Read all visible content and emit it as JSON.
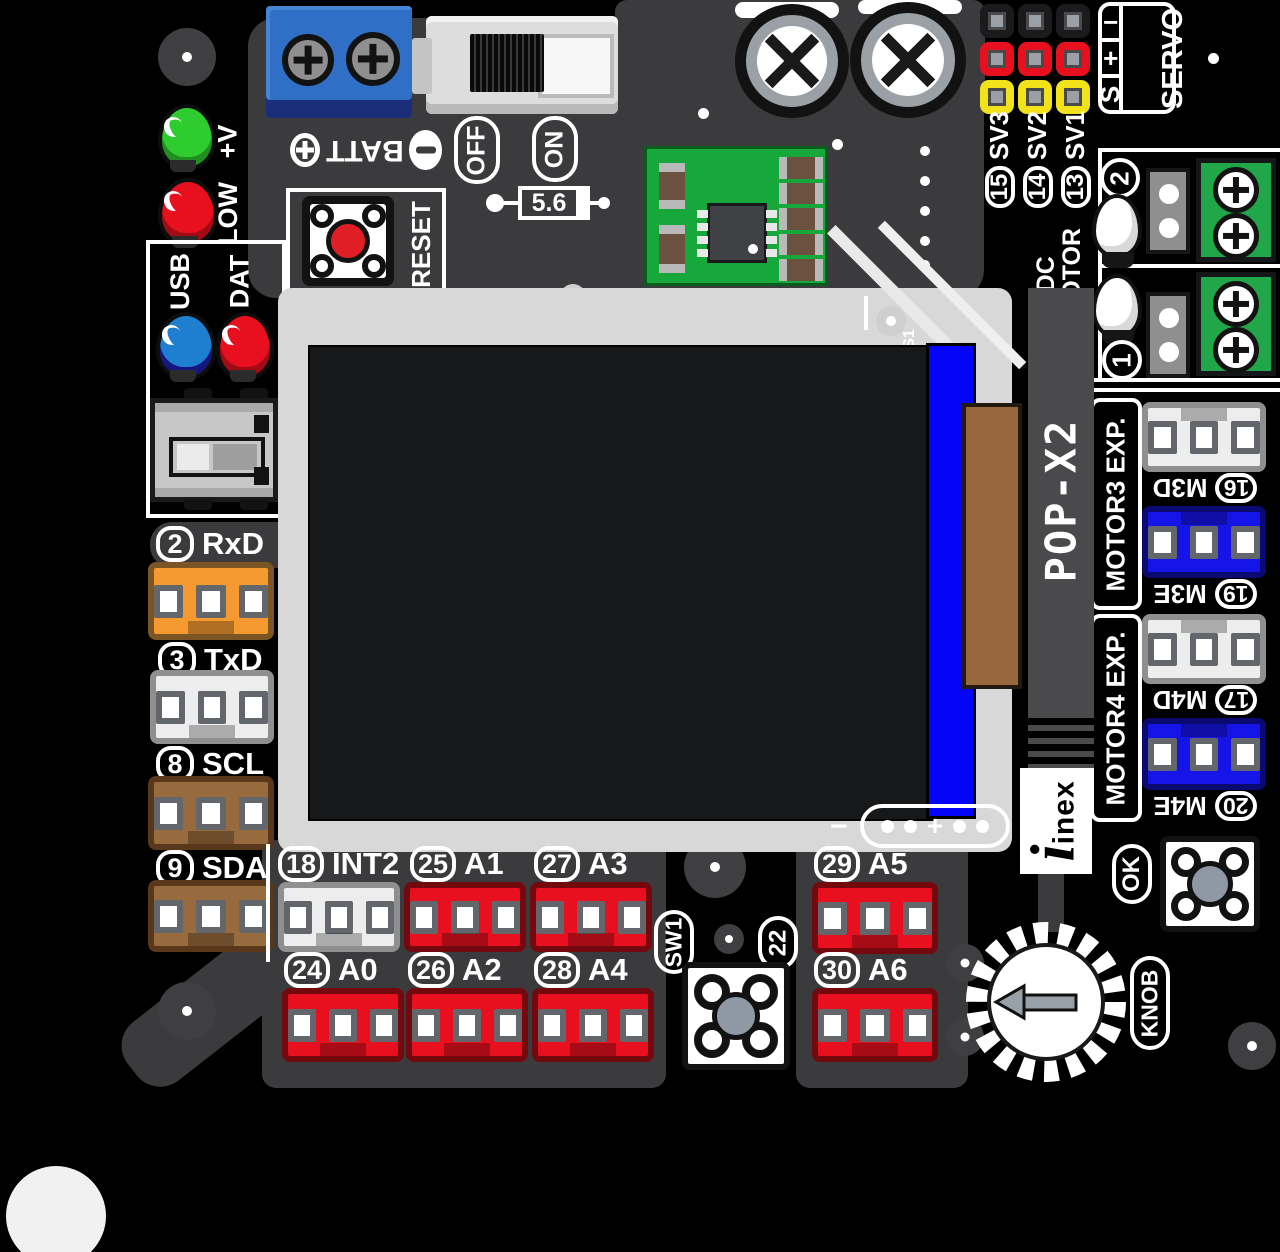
{
  "board": {
    "model": "POP-X2",
    "brand": "inex",
    "screen_marking": "S1"
  },
  "power": {
    "battery_label": "BATT",
    "battery_plus": "+",
    "battery_minus": "−",
    "switch_off": "OFF",
    "switch_on": "ON",
    "zener_value": "5.6",
    "reset_label": "RESET"
  },
  "status_leds": [
    {
      "label": "+V",
      "color": "#2ECC2E"
    },
    {
      "label": "LOW",
      "color": "#E8101F"
    },
    {
      "label": "USB",
      "color": "#1E7FD0"
    },
    {
      "label": "DAT",
      "color": "#E8101F"
    }
  ],
  "servo": {
    "title": "SERVO",
    "pin_rows": [
      {
        "label": "−",
        "color": "#1B1B1D"
      },
      {
        "label": "+",
        "color": "#E8101F"
      },
      {
        "label": "S",
        "color": "#F2E21A"
      }
    ],
    "channels": [
      {
        "num": "15",
        "name": "SV3"
      },
      {
        "num": "14",
        "name": "SV2"
      },
      {
        "num": "13",
        "name": "SV1"
      }
    ]
  },
  "dc_motor": {
    "line1": "DC",
    "line2": "MOTOR",
    "outputs": [
      {
        "num": "2"
      },
      {
        "num": "1"
      }
    ]
  },
  "motor_exp": [
    {
      "title": "MOTOR3 EXP.",
      "ports": [
        {
          "num": "16",
          "name": "M3D",
          "connector_color": "#EDEDED"
        },
        {
          "num": "19",
          "name": "M3E",
          "connector_color": "#1515E8"
        }
      ]
    },
    {
      "title": "MOTOR4 EXP.",
      "ports": [
        {
          "num": "17",
          "name": "M4D",
          "connector_color": "#EDEDED"
        },
        {
          "num": "20",
          "name": "M4E",
          "connector_color": "#1515E8"
        }
      ]
    }
  ],
  "left_headers": [
    {
      "num": "2",
      "name": "RxD",
      "connector_color": "#F49A30"
    },
    {
      "num": "3",
      "name": "TxD",
      "connector_color": "#EDEDED"
    },
    {
      "num": "8",
      "name": "SCL",
      "connector_color": "#976B3D"
    },
    {
      "num": "9",
      "name": "SDA",
      "connector_color": "#976B3D"
    }
  ],
  "bottom_headers": {
    "row1": [
      {
        "num": "18",
        "name": "INT2",
        "connector_color": "#EDEDED"
      },
      {
        "num": "25",
        "name": "A1",
        "connector_color": "#E8101F"
      },
      {
        "num": "27",
        "name": "A3",
        "connector_color": "#E8101F"
      },
      {
        "num": "29",
        "name": "A5",
        "connector_color": "#E8101F"
      }
    ],
    "row2": [
      {
        "num": "24",
        "name": "A0",
        "connector_color": "#E8101F"
      },
      {
        "num": "26",
        "name": "A2",
        "connector_color": "#E8101F"
      },
      {
        "num": "28",
        "name": "A4",
        "connector_color": "#E8101F"
      },
      {
        "num": "30",
        "name": "A6",
        "connector_color": "#E8101F"
      }
    ]
  },
  "buttons": {
    "sw1_label": "SW1",
    "sw1_pin": "22",
    "ok_label": "OK",
    "knob_label": "KNOB"
  },
  "display": {
    "pad_minus": "−",
    "pad_plus": "+"
  }
}
